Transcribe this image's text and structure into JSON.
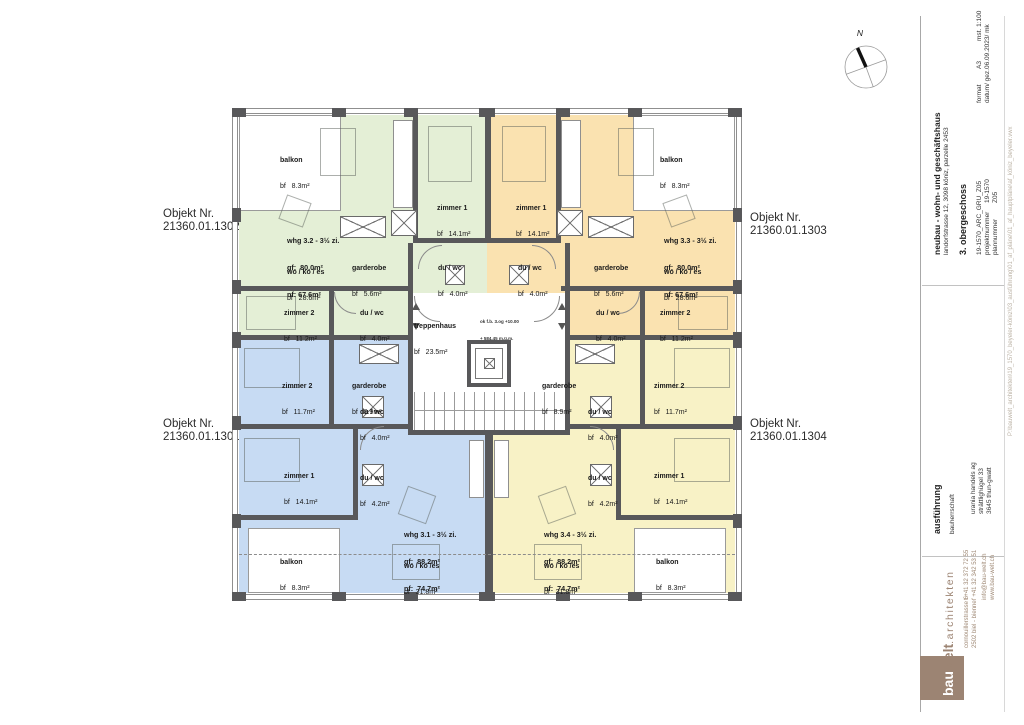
{
  "compass": {
    "north_label": "N"
  },
  "objekt_labels": {
    "tl": {
      "line1": "Objekt Nr.",
      "line2": "21360.01.1302"
    },
    "bl": {
      "line1": "Objekt Nr.",
      "line2": "21360.01.1301"
    },
    "tr": {
      "line1": "Objekt Nr.",
      "line2": "21360.01.1303"
    },
    "br": {
      "line1": "Objekt Nr.",
      "line2": "21360.01.1304"
    }
  },
  "plan": {
    "stairwell": {
      "name": "treppenhaus",
      "area": "bf   23.5m²",
      "note_line1": "ok f.b. 3.og +10.00",
      "note_line2": "+ 584.45 m.ü.m."
    },
    "apartments": {
      "green": {
        "unit": {
          "title": "whg 3.2 - 3½ zi.",
          "gf": "gf:  80.0m²",
          "nf": "nf: 67.6m²"
        },
        "balkon": {
          "name": "balkon",
          "area": "bf   8.3m²"
        },
        "living": {
          "name": "wo / ko / es",
          "area": "bf   28.6m²"
        },
        "garderobe": {
          "name": "garderobe",
          "area": "bf   5.6m²"
        },
        "zimmer1": {
          "name": "zimmer 1",
          "area": "bf   14.1m²"
        },
        "duwc1": {
          "name": "du / wc",
          "area": "bf   4.0m²"
        },
        "zimmer2": {
          "name": "zimmer 2",
          "area": "bf   11.2m²"
        },
        "duwc2": {
          "name": "du / wc",
          "area": "bf   4.0m²"
        }
      },
      "orange": {
        "unit": {
          "title": "whg 3.3 - 3½ zi.",
          "gf": "gf:  80.0m²",
          "nf": "nf: 67.6m²"
        },
        "balkon": {
          "name": "balkon",
          "area": "bf   8.3m²"
        },
        "living": {
          "name": "wo / ko / es",
          "area": "bf   28.6m²"
        },
        "garderobe": {
          "name": "garderobe",
          "area": "bf   5.6m²"
        },
        "zimmer1": {
          "name": "zimmer 1",
          "area": "bf   14.1m²"
        },
        "duwc1": {
          "name": "du / wc",
          "area": "bf   4.0m²"
        },
        "zimmer2": {
          "name": "zimmer 2",
          "area": "bf   11.2m²"
        },
        "duwc2": {
          "name": "du / wc",
          "area": "bf   4.0m²"
        }
      },
      "blue": {
        "unit": {
          "title": "whg 3.1 - 3½ zi.",
          "gf": "gf:  88.2m²",
          "nf": "nf:  74.7m²"
        },
        "balkon": {
          "name": "balkon",
          "area": "bf   8.3m²"
        },
        "living": {
          "name": "wo / ko /es",
          "area": "bf   31.8m²"
        },
        "garderobe": {
          "name": "garderobe",
          "area": "bf   8.9m²"
        },
        "zimmer1": {
          "name": "zimmer 1",
          "area": "bf   14.1m²"
        },
        "duwc1": {
          "name": "du / wc",
          "area": "bf   4.2m²"
        },
        "zimmer2": {
          "name": "zimmer 2",
          "area": "bf   11.7m²"
        },
        "duwc2": {
          "name": "du / wc",
          "area": "bf   4.0m²"
        }
      },
      "yellow": {
        "unit": {
          "title": "whg 3.4 - 3½ zi.",
          "gf": "gf:  88.2m²",
          "nf": "nf:  74.7m²"
        },
        "balkon": {
          "name": "balkon",
          "area": "bf   8.3m²"
        },
        "living": {
          "name": "wo / ko /es",
          "area": "bf   31.8m²"
        },
        "garderobe": {
          "name": "garderobe",
          "area": "bf   8.9m²"
        },
        "zimmer1": {
          "name": "zimmer 1",
          "area": "bf   14.1m²"
        },
        "duwc1": {
          "name": "du / wc",
          "area": "bf   4.2m²"
        },
        "zimmer2": {
          "name": "zimmer 2",
          "area": "bf   11.7m²"
        },
        "duwc2": {
          "name": "du / wc",
          "area": "bf   4.0m²"
        }
      }
    }
  },
  "title_block": {
    "project": {
      "title": "neubau - wohn- und geschäftshaus",
      "address": "landorfstrasse 12, 3098 köniz, parzelle 2453",
      "floor": "3. obergeschoss",
      "doc_code": "19-1570_ARC_GRU_Z05",
      "projektnummer_label": "projektnummer",
      "projektnummer": "19-1570",
      "plannummer_label": "plannummer",
      "plannummer": "Z05",
      "format_label": "format",
      "format": "A3",
      "mst": "mst. 1:100",
      "datum_label": "datum/ gez.",
      "datum": "06.09.2023/ mk"
    },
    "execution": {
      "title": "ausführung",
      "role": "bauherrschaft",
      "client_name": "urania handels ag",
      "client_street": "strättlighügel 33",
      "client_city": "3645 thun-gwatt"
    },
    "firm": {
      "logo_bau": "bau",
      "logo_welt": "welt",
      "logo_rest": ".architekten",
      "street": "cornouillerstrasse 6",
      "city": "2502 biel - bienne",
      "tel": "t +41 32 372 72 55",
      "fax": "f +41 32 342 53 51",
      "email": "info@bau-welt.ch",
      "web": "www.bau-welt.ch"
    },
    "file_path": "P:\\bauwelt_architekten\\19_1570_beyeler-köniz\\03_ausführung\\01_af_pläne\\01_af_hauptpläne\\af_köniz_beyeler.vwx"
  },
  "colors": {
    "green": "#e4efd6",
    "orange": "#fae2b0",
    "blue": "#c7dbf3",
    "yellow": "#f8f2c6",
    "wall": "#58585a",
    "brand_brown": "#9c8473"
  }
}
